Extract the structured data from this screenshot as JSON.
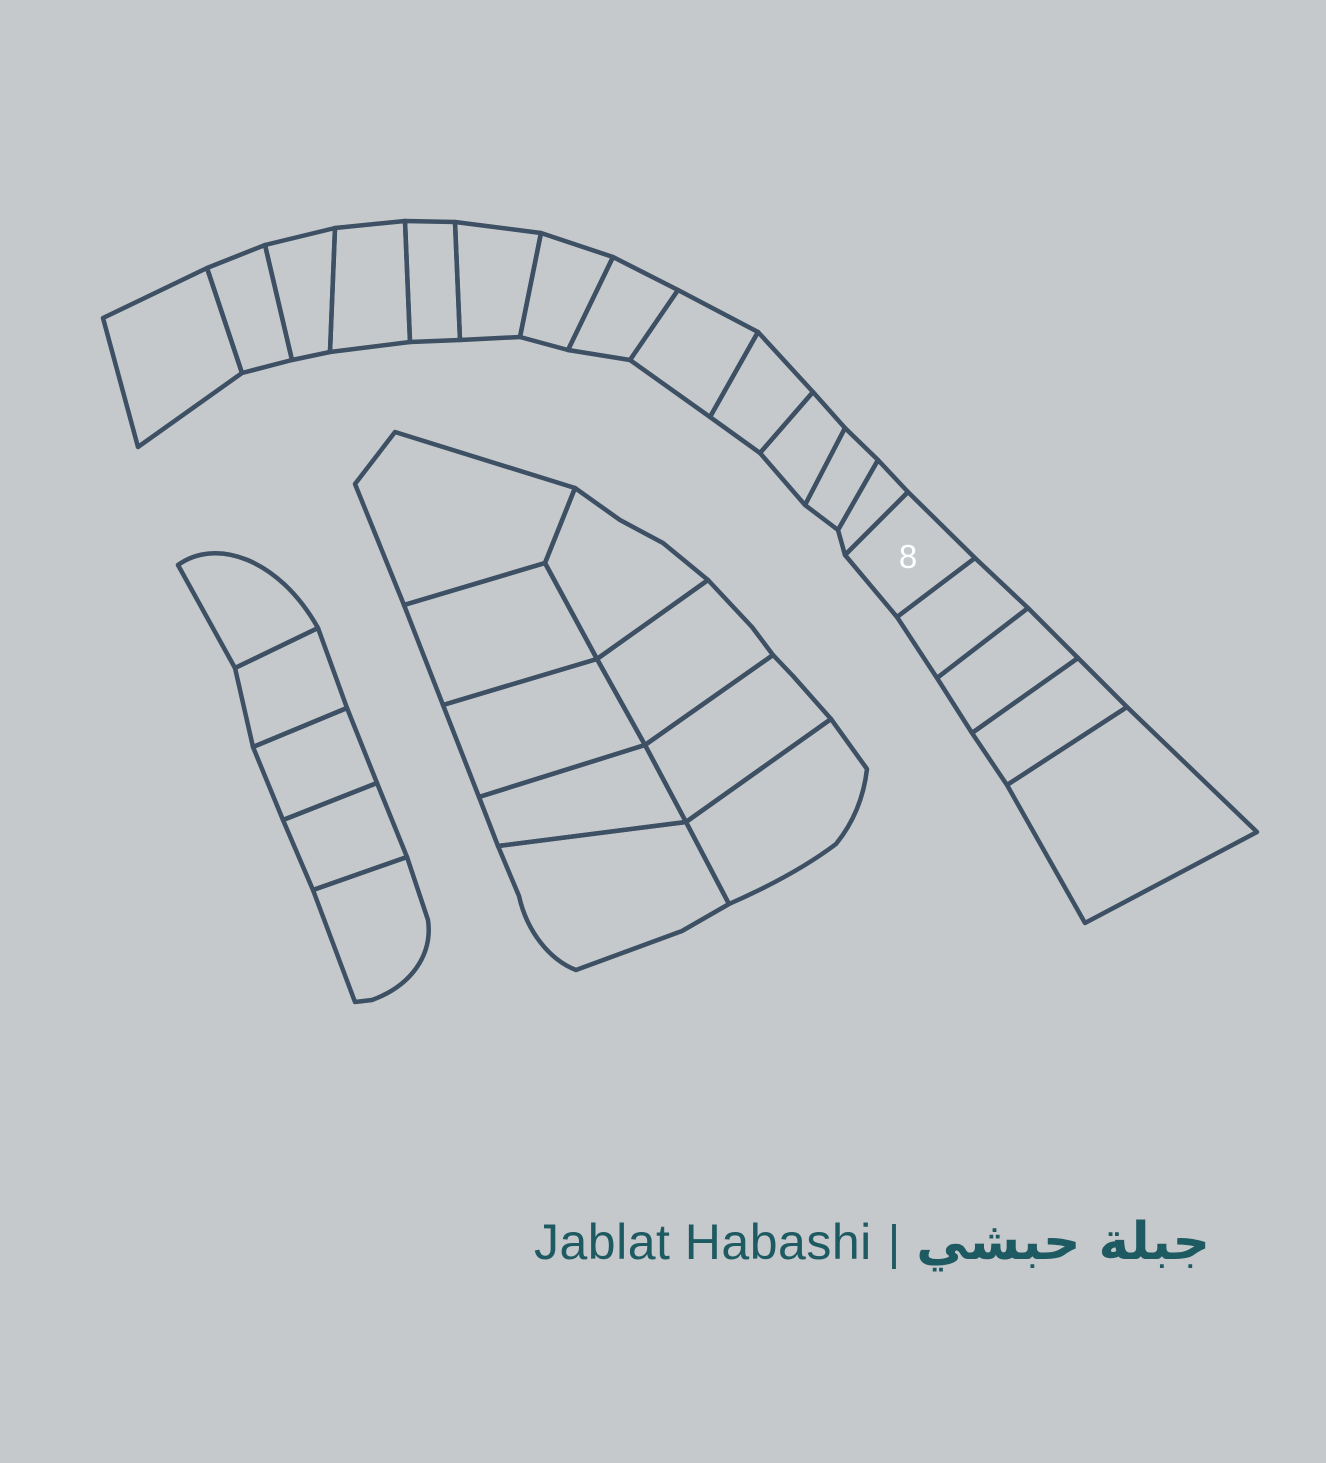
{
  "page": {
    "background_color": "#c6c9cc"
  },
  "map": {
    "line_color": "#3d5064",
    "highlight": {
      "label": "8",
      "fill": "#364a5c",
      "label_color": "#ffffff"
    }
  },
  "footer": {
    "title_latin": "Jablat Habashi",
    "separator": "|",
    "title_arabic": "جبلة حبشي",
    "text_color": "#1e5a62"
  }
}
